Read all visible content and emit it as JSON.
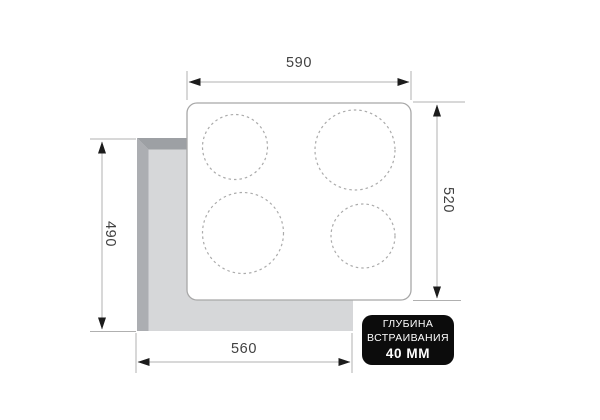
{
  "diagram": {
    "kind": "built-in-hob-installation-dimensions",
    "dimensions": {
      "top_width": {
        "value": "590",
        "orientation": "horizontal"
      },
      "right_height": {
        "value": "520",
        "orientation": "vertical"
      },
      "left_cutout_height": {
        "value": "490",
        "orientation": "vertical"
      },
      "bottom_cutout_width": {
        "value": "560",
        "orientation": "horizontal"
      }
    },
    "badge": {
      "line1": "ГЛУБИНА",
      "line2": "ВСТРАИВАНИЯ",
      "line3": "40 ММ"
    },
    "burners": [
      {
        "position": "top-left",
        "size": "small"
      },
      {
        "position": "top-right",
        "size": "large"
      },
      {
        "position": "bottom-left",
        "size": "large"
      },
      {
        "position": "bottom-right",
        "size": "small"
      }
    ],
    "colors": {
      "background": "#ffffff",
      "cooktop_fill": "#ffffff",
      "cooktop_border": "#a8a8a8",
      "cutout_surface": "#d6d7d9",
      "cutout_rim_top": "#9da0a4",
      "cutout_rim_left": "#acaeb2",
      "dimension_line": "#b0b0b0",
      "arrowhead": "#1c1c1c",
      "dimension_text": "#414141",
      "badge_background": "#0c0c0c",
      "badge_text": "#ffffff",
      "burner_dash": "#ababab"
    }
  }
}
